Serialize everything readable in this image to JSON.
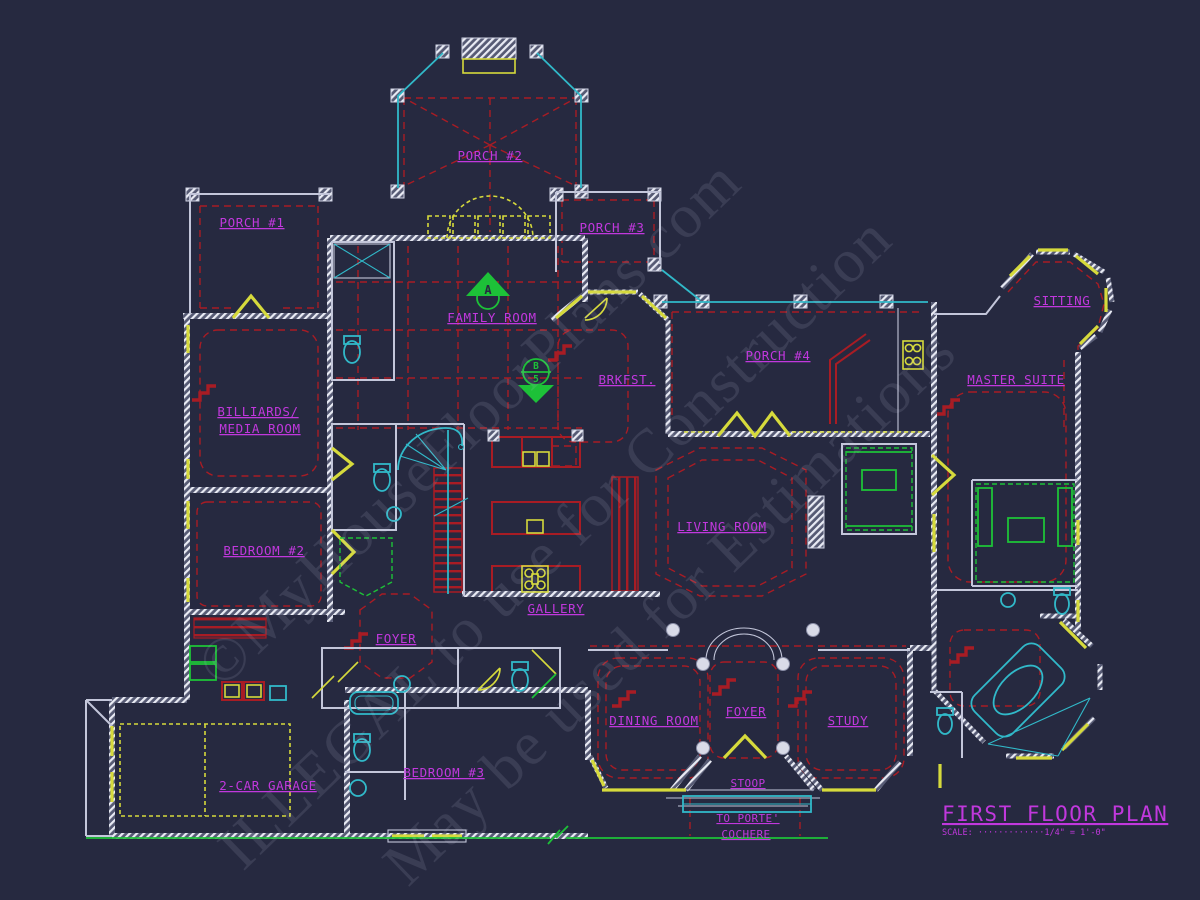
{
  "colors": {
    "bg": "#262940",
    "wall": "#c3c6da",
    "yellow": "#d6da3c",
    "red": "#a81c24",
    "cyan": "#31b9c9",
    "green": "#1dc138",
    "magenta": "#c138dd"
  },
  "labels": {
    "porch2": "PORCH #2",
    "porch1": "PORCH #1",
    "porch3": "PORCH #3",
    "porch4": "PORCH #4",
    "sitting": "SITTING",
    "family_room": "FAMILY ROOM",
    "master_suite": "MASTER SUITE",
    "brkfst": "BRKFST.",
    "billiards_line1": "BILLIARDS/",
    "billiards_line2": "MEDIA ROOM",
    "bedroom2": "BEDROOM #2",
    "living_room": "LIVING ROOM",
    "gallery": "GALLERY",
    "foyer_left": "FOYER",
    "dining_room": "DINING ROOM",
    "foyer_main": "FOYER",
    "study": "STUDY",
    "garage": "2-CAR GARAGE",
    "bedroom3": "BEDROOM #3",
    "stoop": "STOOP",
    "porte_line1": "TO PORTE'",
    "porte_line2": "COCHERE"
  },
  "markers": {
    "a": "A",
    "b": "B",
    "b_num": "5"
  },
  "title_block": {
    "title": "FIRST FLOOR PLAN",
    "scale": "SCALE: ·············1/4\" = 1'-0\""
  },
  "watermark": {
    "line1": "©MyHouseFloorPlans.com",
    "line2": "ILLEGAL to use for Construction",
    "line3": "May be used for Estimations"
  }
}
